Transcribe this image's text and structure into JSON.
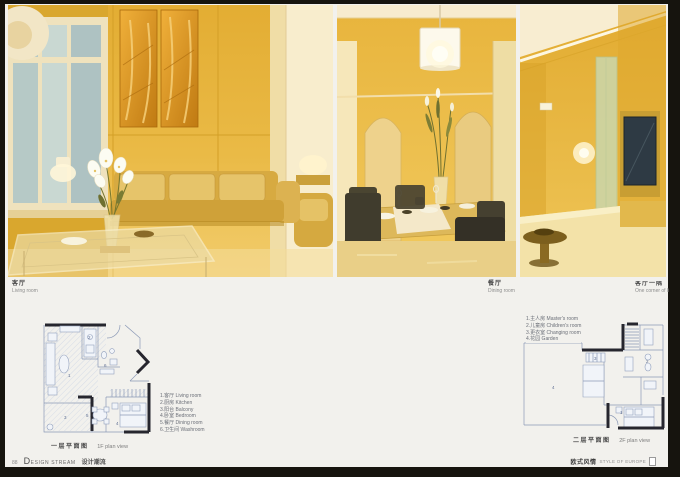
{
  "page": {
    "footer": {
      "page_number": "88",
      "brand_en": "DESIGN STREAM",
      "brand_cn": "设计潮流",
      "right_cn": "欧式风情",
      "right_en": "STYLE OF EUROPE"
    }
  },
  "photos": [
    {
      "caption_cn": "客厅",
      "caption_en": "Living room"
    },
    {
      "caption_cn": "餐厅",
      "caption_en": "Dining room"
    },
    {
      "caption_cn": "客厅一隅",
      "caption_en": "One corner of living room"
    }
  ],
  "plans": [
    {
      "legend": [
        "1.客厅 Living room",
        "2.厨房 Kitchen",
        "3.阳台 Balcony",
        "4.卧室 Bedroom",
        "5.餐厅 Dining room",
        "6.卫生间 Washroom"
      ],
      "room_numbers": [
        "1",
        "2",
        "3",
        "4",
        "5",
        "6"
      ],
      "caption_cn": "一层平面图",
      "caption_en": "1F plan view"
    },
    {
      "legend": [
        "1.主人房 Master's room",
        "2.儿童房 Children's room",
        "3.更衣室 Changing room",
        "4.花园 Garden"
      ],
      "room_numbers": [
        "1",
        "2",
        "3",
        "4"
      ],
      "caption_cn": "二层平面图",
      "caption_en": "2F plan view"
    }
  ]
}
